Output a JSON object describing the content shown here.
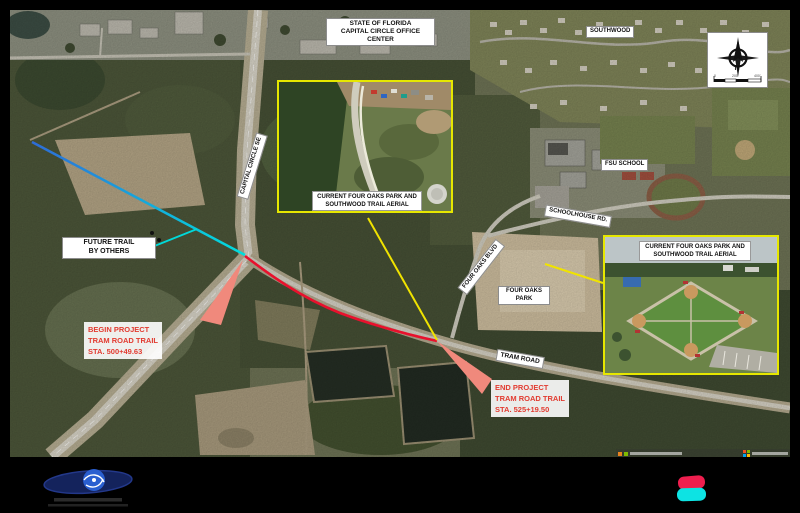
{
  "area_labels": {
    "state_of_florida_line1": "STATE OF FLORIDA",
    "state_of_florida_line2": "CAPITAL CIRCLE OFFICE CENTER",
    "southwood": "SOUTHWOOD",
    "fsu_school": "FSU SCHOOL",
    "four_oaks_park_line1": "FOUR OAKS",
    "four_oaks_park_line2": "PARK"
  },
  "road_labels": {
    "capital_circle_se": "CAPITAL CIRCLE SE",
    "four_oaks_blvd": "FOUR OAKS BLVD",
    "schoolhouse_rd": "SCHOOLHOUSE RD.",
    "tram_road": "TRAM ROAD"
  },
  "callouts": {
    "future_trail_line1": "FUTURE TRAIL",
    "future_trail_line2": "BY OTHERS",
    "begin_line1": "BEGIN PROJECT",
    "begin_line2": "TRAM ROAD TRAIL",
    "begin_line3": "STA. 500+49.63",
    "end_line1": "END PROJECT",
    "end_line2": "TRAM ROAD TRAIL",
    "end_line3": "STA. 525+19.50"
  },
  "inset_caption": {
    "line1": "CURRENT FOUR OAKS PARK AND",
    "line2": "SOUTHWOOD TRAIL AERIAL"
  },
  "compass": {
    "north": "N"
  },
  "scale_bar": {
    "tick_left": "0",
    "tick_mid": "200'",
    "tick_right": "400'"
  },
  "icons": {
    "compass": "north-arrow-icon",
    "attribution_right": "microsoft-logo-icon",
    "attribution_left": "map-provider-squares-icon",
    "footer_left": "engineering-firm-logo",
    "footer_right": "brand-mark-pink-cyan"
  },
  "colors": {
    "project_trail_red": "#e8112d",
    "future_trail_blue": "#2e6cd8",
    "future_trail_cyan": "#00dede",
    "leader_salmon": "#f0897c",
    "leader_yellow": "#f0e300",
    "callout_red_text": "#e23b30",
    "inset_border_yellow": "#e6e700",
    "brand_pink": "#ee1e4e",
    "brand_cyan": "#0de3e3"
  }
}
